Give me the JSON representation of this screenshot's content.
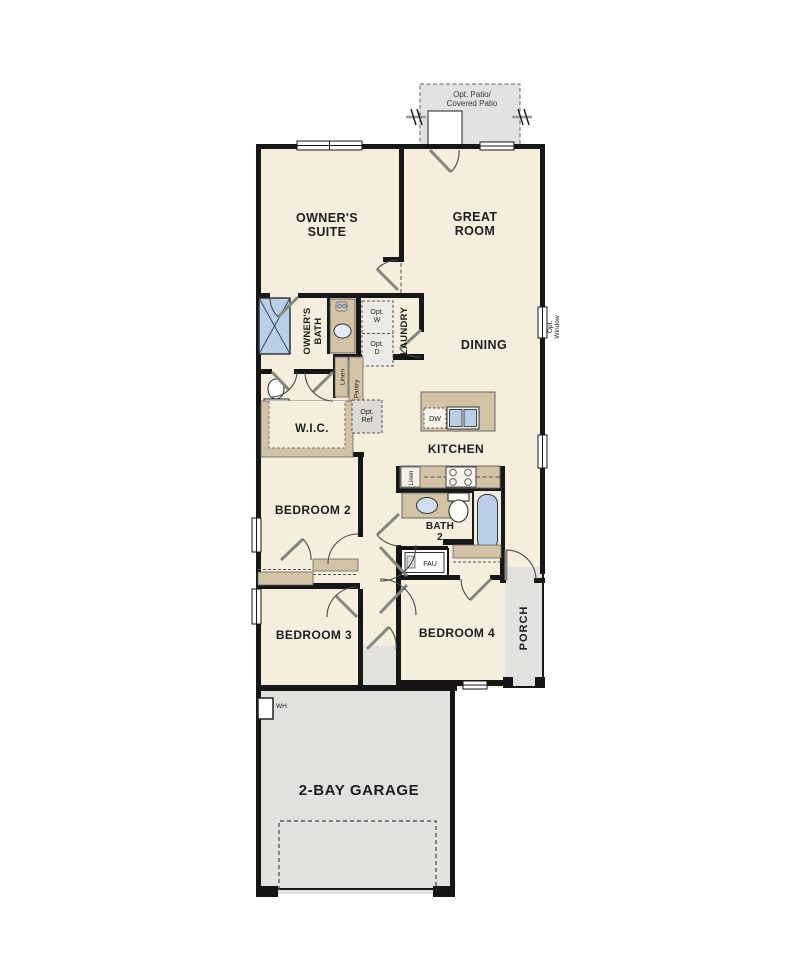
{
  "plan": {
    "labels": {
      "patio1": "Opt. Patio/",
      "patio2": "Covered Patio",
      "owners_suite1": "OWNER'S",
      "owners_suite2": "SUITE",
      "great_room1": "GREAT",
      "great_room2": "ROOM",
      "owners_bath1": "OWNER'S",
      "owners_bath2": "BATH",
      "laundry": "LAUNDRY",
      "opt_w1": "Opt.",
      "opt_w2": "W",
      "opt_d1": "Opt.",
      "opt_d2": "D",
      "opt_window1": "Opt.",
      "opt_window2": "Window",
      "dining": "DINING",
      "linen_hall": "Linen",
      "pantry": "Pantry",
      "wic": "W.I.C.",
      "opt_ref1": "Opt.",
      "opt_ref2": "Ref",
      "dw": "DW",
      "kitchen": "KITCHEN",
      "linen_kitchen": "Linen",
      "bedroom2": "BEDROOM 2",
      "bath2_1": "BATH",
      "bath2_2": "2",
      "fau": "FAU",
      "bedroom3": "BEDROOM 3",
      "bedroom4": "BEDROOM 4",
      "porch": "PORCH",
      "garage": "2-BAY GARAGE",
      "wh": "WH"
    },
    "colors": {
      "floor": "#f6eedd",
      "outdoor": "#e3e1de",
      "counter": "#d2c3a5",
      "fixture_blue": "#b9cfe8",
      "wall": "#161616"
    }
  }
}
